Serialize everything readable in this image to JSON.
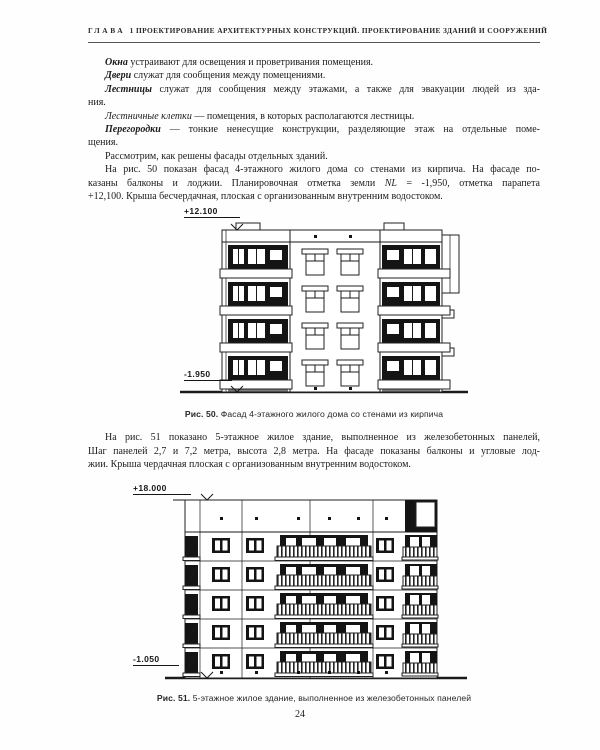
{
  "header": {
    "chapter": "ГЛАВА 1",
    "title": "ПРОЕКТИРОВАНИЕ АРХИТЕКТУРНЫХ КОНСТРУКЦИЙ.  ПРОЕКТИРОВАНИЕ ЗДАНИЙ И СООРУЖЕНИЙ"
  },
  "body1": {
    "l1": {
      "lead": "Окна",
      "rest": " устраивают для освещения и проветривания помещения."
    },
    "l2": {
      "lead": "Двери",
      "rest": " служат для сообщения между помещениями."
    },
    "l3": {
      "lead": "Лестницы",
      "rest": " служат для сообщения между этажами, а также для эвакуации людей из зда-"
    },
    "l4": {
      "text": "ния."
    },
    "l5": {
      "lead": "Лестничные клетки",
      "rest": " — помещения, в которых располагаются лестницы."
    },
    "l6": {
      "lead": "Перегородки",
      "rest": " — тонкие ненесущие конструкции, разделяющие этаж на отдельные поме-"
    },
    "l7": {
      "text": "щения."
    },
    "l8": {
      "text": "Рассмотрим, как решены фасады отдельных зданий."
    },
    "l9": {
      "text": "На рис. 50 показан фасад 4-этажного жилого дома со стенами из кирпича. На фасаде по-"
    },
    "l10": {
      "pre": "казаны балконы и лоджии. Планировочная отметка земли ",
      "nl": "NL",
      "post": " = -1,950, отметка парапета"
    },
    "l11": {
      "text": "+12,100. Крыша бесчердачная, плоская с организованным внутренним водостоком."
    }
  },
  "fig50": {
    "elevation_top": "+12.100",
    "elevation_bottom": "-1.950",
    "caption_label": "Рис. 50.",
    "caption_text": " Фасад 4-этажного жилого дома со стенами из кирпича"
  },
  "body2": {
    "l1": {
      "text": "На рис. 51 показано 5-этажное жилое здание, выполненное из железобетонных панелей,"
    },
    "l2": {
      "text": "Шаг панелей 2,7 и 7,2 метра, высота 2,8 метра. На фасаде показаны балконы и угловые лод-"
    },
    "l3": {
      "text": "жии. Крыша чердачная плоская с организованным внутренним водостоком."
    }
  },
  "fig51": {
    "elevation_top": "+18.000",
    "elevation_bottom": "-1.050",
    "caption_label": "Рис. 51.",
    "caption_text": " 5-этажное жилое здание, выполненное из железобетонных панелей"
  },
  "page_number": "24",
  "colors": {
    "ink": "#1a1a1a",
    "paper": "#fefefe"
  }
}
